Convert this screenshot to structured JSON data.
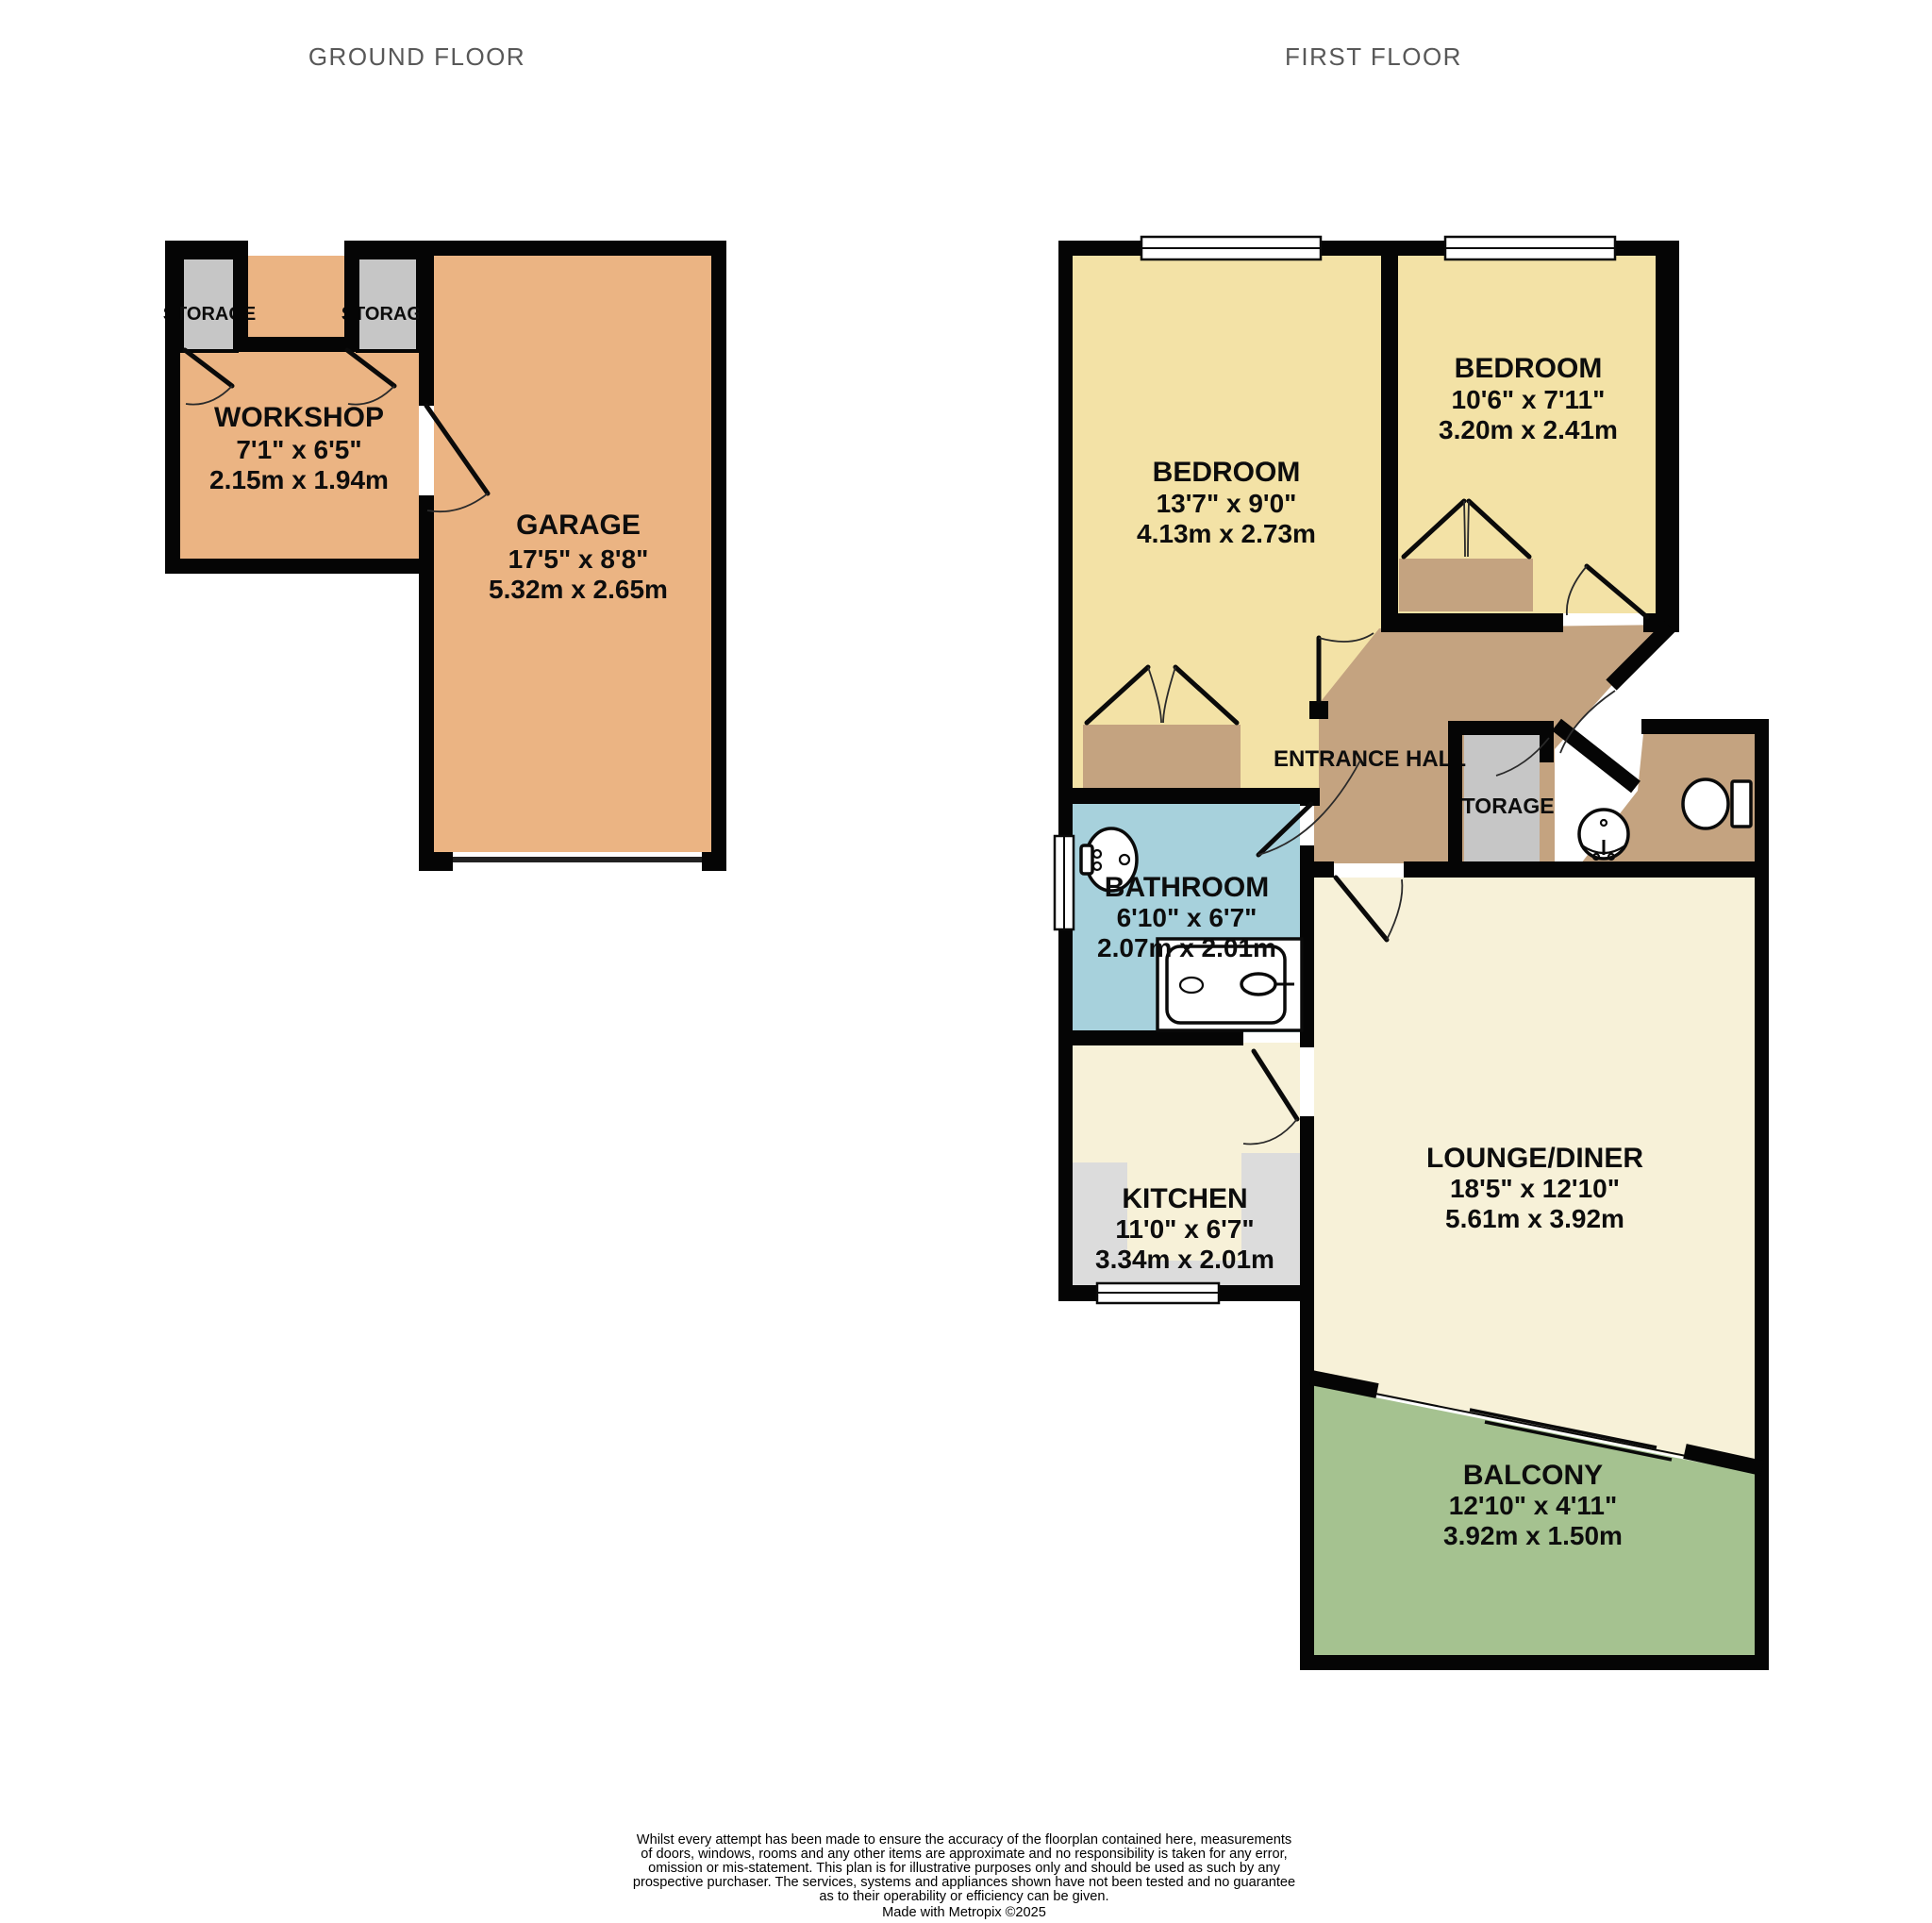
{
  "titles": {
    "ground_floor": "GROUND FLOOR",
    "first_floor": "FIRST FLOOR"
  },
  "ground_floor": {
    "workshop": {
      "name": "WORKSHOP",
      "imperial": "7'1\"  x 6'5\"",
      "metric": "2.15m  x 1.94m"
    },
    "garage": {
      "name": "GARAGE",
      "imperial": "17'5\"  x 8'8\"",
      "metric": "5.32m  x 2.65m"
    },
    "storage_left": "STORAGE",
    "storage_right": "STORAGE"
  },
  "first_floor": {
    "bedroom_left": {
      "name": "BEDROOM",
      "imperial": "13'7\"  x 9'0\"",
      "metric": "4.13m  x 2.73m"
    },
    "bedroom_right": {
      "name": "BEDROOM",
      "imperial": "10'6\"  x 7'11\"",
      "metric": "3.20m  x 2.41m"
    },
    "bathroom": {
      "name": "BATHROOM",
      "imperial": "6'10\"  x 6'7\"",
      "metric": "2.07m  x 2.01m"
    },
    "kitchen": {
      "name": "KITCHEN",
      "imperial": "11'0\"  x 6'7\"",
      "metric": "3.34m  x 2.01m"
    },
    "lounge_diner": {
      "name": "LOUNGE/DINER",
      "imperial": "18'5\"  x 12'10\"",
      "metric": "5.61m  x 3.92m"
    },
    "balcony": {
      "name": "BALCONY",
      "imperial": "12'10\"  x 4'11\"",
      "metric": "3.92m  x 1.50m"
    },
    "entrance_hall": "ENTRANCE HALL",
    "storage": "STORAGE"
  },
  "footer": {
    "lines": [
      "Whilst every attempt has been made to ensure the accuracy of the floorplan contained here, measurements",
      "of doors, windows, rooms and any other items are approximate and no responsibility is taken for any error,",
      "omission or mis-statement. This plan is for illustrative purposes only and should be used as such by any",
      "prospective purchaser. The services, systems and appliances shown have not been tested and no guarantee",
      "as to their operability or efficiency can be given.",
      "Made with Metropix ©2025"
    ]
  },
  "colors": {
    "garage_workshop": "#ebb483",
    "bedroom": "#f3e2a6",
    "hall_tan": "#c4a380",
    "bathroom_blue": "#a7d1dc",
    "cream": "#f7f1d8",
    "balcony_green": "#a5c290",
    "storage_gray": "#c6c6c6",
    "counter_gray": "#dcdcdc",
    "wall": "#050505",
    "title_gray": "#585858"
  }
}
